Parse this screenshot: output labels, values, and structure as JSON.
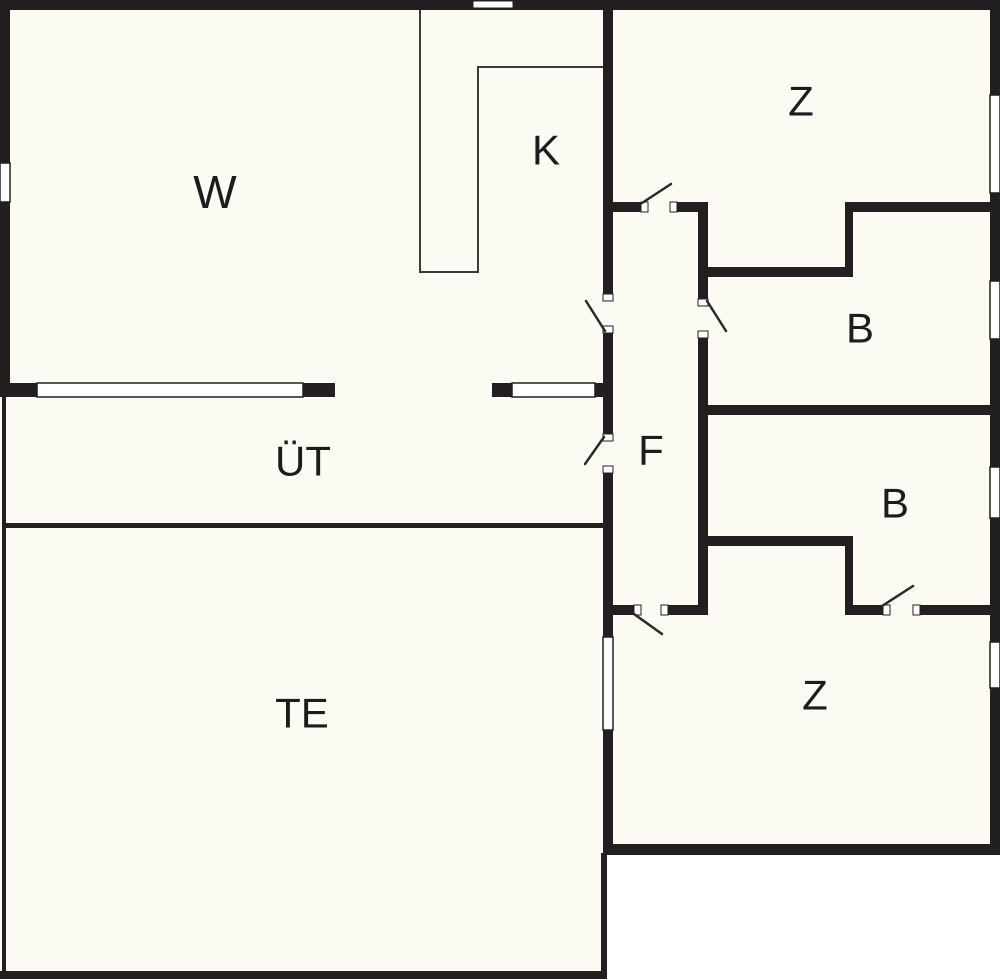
{
  "plan": {
    "colors": {
      "outside": "#ffffff",
      "floor": "#fbfaf3",
      "wall": "#231f20",
      "thin_wall": "#3a3a3a",
      "window_fill": "#ffffff",
      "window_stroke": "#231f20",
      "swing": "#2a2a2a",
      "label": "#1c1c1c"
    },
    "canvas": {
      "width": 1000,
      "height": 980
    },
    "floor_areas": [
      [
        0,
        0,
        1000,
        855
      ],
      [
        0,
        397,
        607,
        581
      ]
    ],
    "walls_thick": [
      [
        0,
        0,
        1000,
        10
      ],
      [
        0,
        383,
        37,
        14
      ],
      [
        303,
        383,
        32,
        14
      ],
      [
        492,
        383,
        20,
        14
      ],
      [
        595,
        383,
        18,
        14
      ],
      [
        613,
        202,
        29,
        10
      ],
      [
        677,
        202,
        28,
        10
      ],
      [
        845,
        202,
        155,
        10
      ],
      [
        698,
        267,
        155,
        10
      ],
      [
        698,
        405,
        302,
        10
      ],
      [
        698,
        536,
        155,
        10
      ],
      [
        603,
        605,
        32,
        10
      ],
      [
        668,
        605,
        40,
        10
      ],
      [
        845,
        605,
        38,
        10
      ],
      [
        920,
        605,
        80,
        10
      ],
      [
        603,
        844,
        397,
        11
      ],
      [
        3,
        523,
        600,
        5
      ],
      [
        0,
        971,
        607,
        8
      ],
      [
        0,
        0,
        10,
        163
      ],
      [
        0,
        202,
        10,
        181
      ],
      [
        990,
        0,
        10,
        95
      ],
      [
        990,
        193,
        10,
        88
      ],
      [
        990,
        339,
        10,
        128
      ],
      [
        990,
        518,
        10,
        124
      ],
      [
        990,
        688,
        10,
        156
      ],
      [
        603,
        0,
        10,
        295
      ],
      [
        603,
        332,
        10,
        103
      ],
      [
        603,
        473,
        10,
        164
      ],
      [
        603,
        730,
        10,
        114
      ],
      [
        698,
        202,
        10,
        98
      ],
      [
        698,
        338,
        10,
        277
      ],
      [
        845,
        202,
        8,
        75
      ],
      [
        845,
        536,
        8,
        79
      ],
      [
        601,
        853,
        6,
        126
      ],
      [
        2,
        397,
        4,
        582
      ]
    ],
    "walls_thin": [
      [
        419,
        10,
        2,
        263
      ],
      [
        419,
        271,
        60,
        2
      ],
      [
        477,
        66,
        2,
        207
      ],
      [
        477,
        66,
        130,
        2
      ]
    ],
    "windows": [
      [
        0,
        163,
        10,
        39
      ],
      [
        37,
        383,
        266,
        14
      ],
      [
        512,
        383,
        83,
        14
      ],
      [
        990,
        95,
        10,
        98
      ],
      [
        990,
        281,
        10,
        58
      ],
      [
        990,
        467,
        10,
        51
      ],
      [
        990,
        642,
        10,
        46
      ],
      [
        603,
        637,
        10,
        93
      ]
    ],
    "chimney_vent": [
      473,
      1,
      40,
      7
    ],
    "door_jambs": [
      [
        641,
        202,
        7,
        10
      ],
      [
        670,
        202,
        7,
        10
      ],
      [
        603,
        294,
        10,
        7
      ],
      [
        603,
        326,
        10,
        7
      ],
      [
        603,
        434,
        10,
        7
      ],
      [
        603,
        466,
        10,
        7
      ],
      [
        698,
        299,
        10,
        7
      ],
      [
        698,
        331,
        10,
        7
      ],
      [
        634,
        605,
        7,
        10
      ],
      [
        661,
        605,
        7,
        10
      ],
      [
        883,
        605,
        7,
        10
      ],
      [
        913,
        605,
        7,
        10
      ]
    ],
    "door_swings": [
      [
        642,
        203,
        671,
        184
      ],
      [
        605,
        331,
        586,
        301
      ],
      [
        604,
        437,
        585,
        464
      ],
      [
        707,
        301,
        726,
        331
      ],
      [
        634,
        614,
        662,
        634
      ],
      [
        882,
        606,
        913,
        586
      ]
    ],
    "rooms": [
      {
        "id": "w",
        "label": "W",
        "x": 215,
        "y": 192,
        "size": 46
      },
      {
        "id": "k",
        "label": "K",
        "x": 546,
        "y": 150,
        "size": 42
      },
      {
        "id": "z-top",
        "label": "Z",
        "x": 801,
        "y": 101,
        "size": 42
      },
      {
        "id": "b-top",
        "label": "B",
        "x": 860,
        "y": 328,
        "size": 42
      },
      {
        "id": "f",
        "label": "F",
        "x": 651,
        "y": 450,
        "size": 42
      },
      {
        "id": "b-bottom",
        "label": "B",
        "x": 895,
        "y": 503,
        "size": 42
      },
      {
        "id": "z-bottom",
        "label": "Z",
        "x": 815,
        "y": 695,
        "size": 42
      },
      {
        "id": "ut",
        "label": "ÜT",
        "x": 303,
        "y": 461,
        "size": 42
      },
      {
        "id": "te",
        "label": "TE",
        "x": 302,
        "y": 713,
        "size": 42
      }
    ]
  }
}
